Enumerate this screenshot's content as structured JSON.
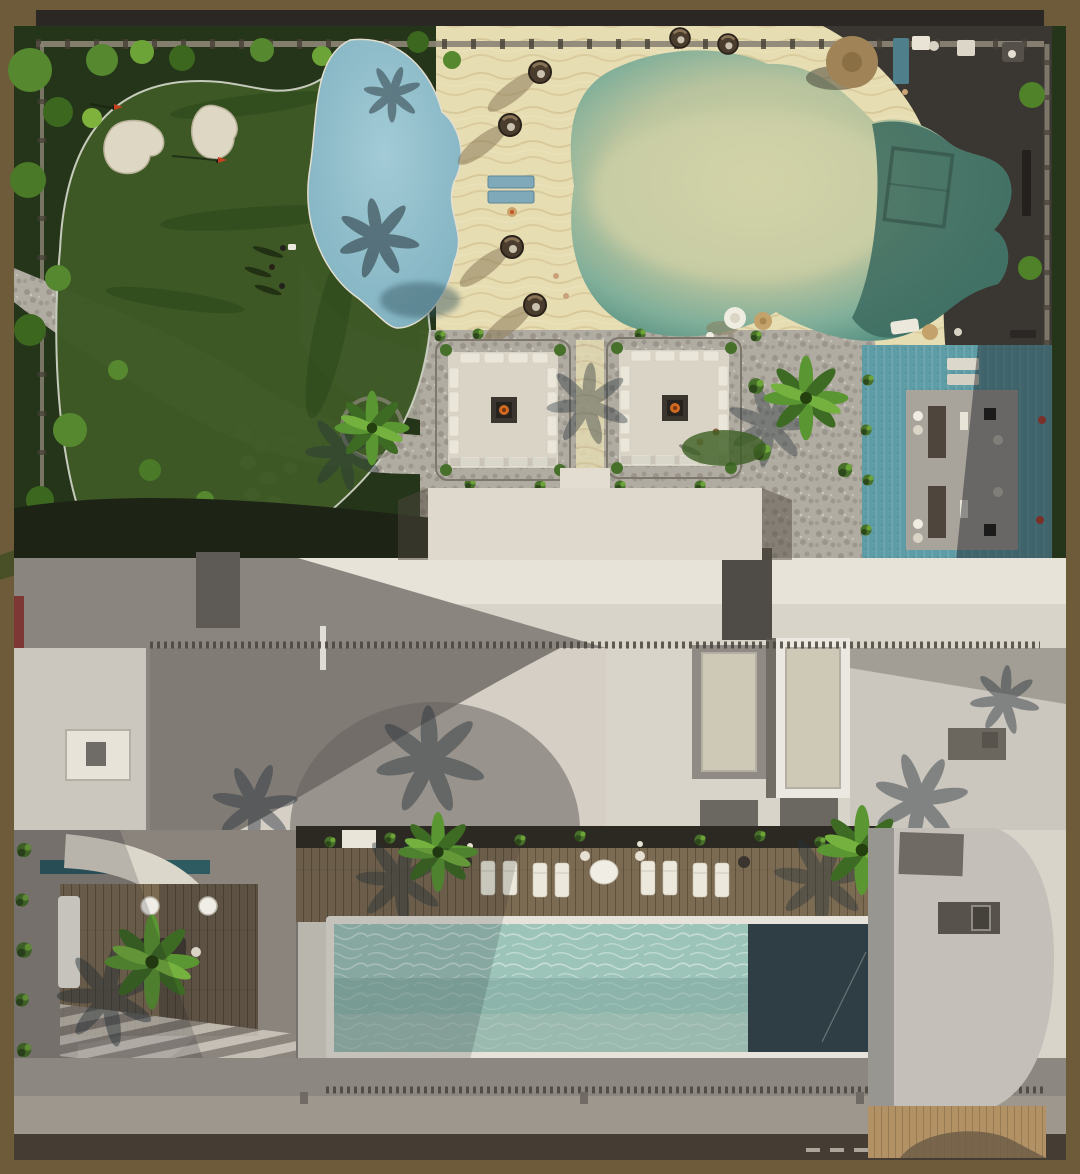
{
  "scene": {
    "title": "aerial-top-view-render-resort-amenity-deck",
    "regions": [
      "putting-green",
      "sand-bunkers",
      "garden-lawn",
      "cobblestone-path",
      "stepping-stones",
      "splash-pond",
      "sand-beach",
      "beach-lagoon-pool",
      "volleyball-net-shadow",
      "hanging-egg-chairs",
      "beach-loungers",
      "beach-umbrella",
      "fire-pit-courtyards",
      "palm-trees",
      "promenade-dark-paving",
      "teal-pool-deck",
      "cabana-pergola",
      "building-roof",
      "roof-skylights",
      "rooftop-lap-pool",
      "wood-pool-deck",
      "pool-loungers",
      "lounge-terrace",
      "striped-paving",
      "parapet-walk",
      "timber-deck-strip"
    ]
  },
  "palette": {
    "frame": "#6d5b39",
    "frame_bar": "#2b2724",
    "wall_line": "#8d8577",
    "wall_tick": "#453f36",
    "lawn_dark": "#25351a",
    "lawn": "#2f451d",
    "putting_green": "#3e5926",
    "green_edge": "#c9cdbf",
    "bunker": "#ded7c3",
    "flag_red": "#c4401f",
    "tree": "#55882f",
    "tree_dark": "#2d481b",
    "tree_light": "#7fb23c",
    "shrub": "#47702a",
    "cobble": "#b1aca2",
    "cobble_dark": "#868077",
    "stepping_stone": "#e3ded2",
    "pond": "#92bfcb",
    "pond_shadow": "#33535e",
    "sand": "#e7ddb3",
    "sand_ripple": "#d2c190",
    "lagoon_shallow": "#cdd0a5",
    "lagoon_mid": "#b9c49e",
    "lagoon_teal": "#7fae99",
    "lagoon_deep": "#569081",
    "lagoon_shadow": "#3e6c60",
    "dark_paving": "#3a3632",
    "wicker": "#4a3d2e",
    "lounge_blue": "#7fa9b8",
    "court_paving": "#dad4c6",
    "sofa": "#eae6da",
    "firepit": "#26221e",
    "fire": "#d06a22",
    "teal_deck": "#5f9da6",
    "cabana": "#a8a39b",
    "cabana_dark": "#4e463c",
    "roof_light": "#e8e3d9",
    "roof_beige": "#d9d4c9",
    "roof_gray": "#8a857f",
    "roof_gray_dark": "#6f6b66",
    "panel_light": "#cbc6be",
    "skylight_frame": "#ebe8e1",
    "skylight_fill": "#cec8b6",
    "joint": "#4a443c",
    "deck_wood": "#7c6b53",
    "planting": "#2b2922",
    "palm": "#5a9733",
    "palm_dark": "#3e6b24",
    "pool_coping": "#e7e3da",
    "pool_water": "#9dc4b9",
    "pool_water_mid": "#7da79e",
    "pool_end": "#2f3e44",
    "terrace": "#8d8781",
    "parapet": "#9e978e",
    "band_dark": "#453d33",
    "tan_deck": "#b29264",
    "oval_wall": "#dcd7cb",
    "water_strip": "#2e5a62",
    "white": "#f2efe8",
    "shadow": "#14161c",
    "umbrella_tan": "#a08457",
    "kiosk_teal": "#4e7f8a"
  }
}
